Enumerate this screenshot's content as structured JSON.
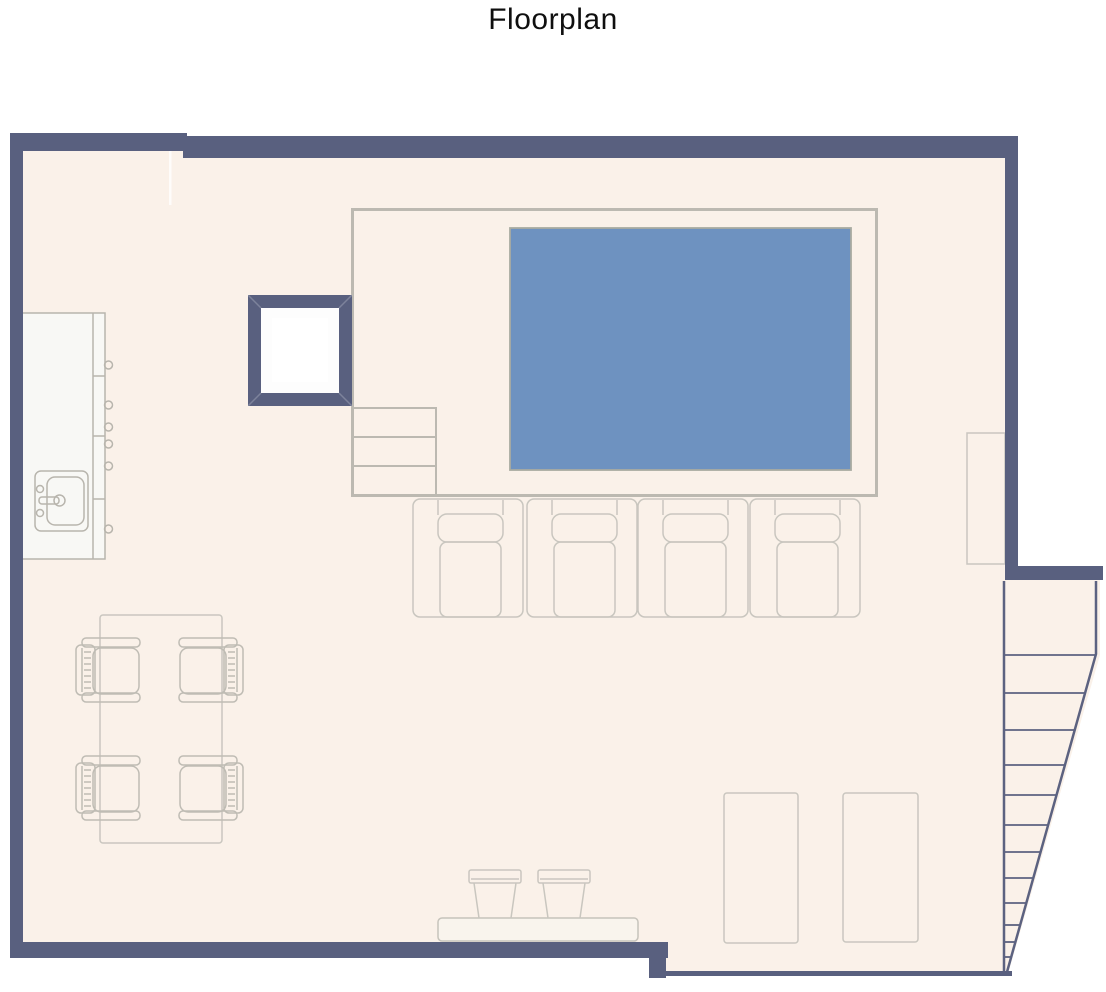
{
  "title": "Floorplan",
  "colors": {
    "background": "#ffffff",
    "title_text": "#0f0f0f",
    "wall": "#59607f",
    "floor": "#faf1e9",
    "pool_water": "#6e92c0",
    "pool_border": "#a9aba1",
    "enclosure_outline": "#bcb9b1",
    "furniture_outline": "#c9c6bf",
    "counter_outline": "#b8b5ad",
    "counter_fill": "#f8f8f5",
    "column_interior": "#fdfdfd",
    "stair_line": "#5c6280"
  },
  "plan": {
    "visible_elements": {
      "pool": 1,
      "pool_steps": 3,
      "sun_loungers": 4,
      "dining_table": 1,
      "dining_chairs": 4,
      "kitchen_counter": 1,
      "sink": 1,
      "counter_knobs": 6,
      "skylight_column": 1,
      "wall_cabinet": 1,
      "floor_mats": 2,
      "bench": 1,
      "stools": 2,
      "stair_treads": 12
    }
  }
}
